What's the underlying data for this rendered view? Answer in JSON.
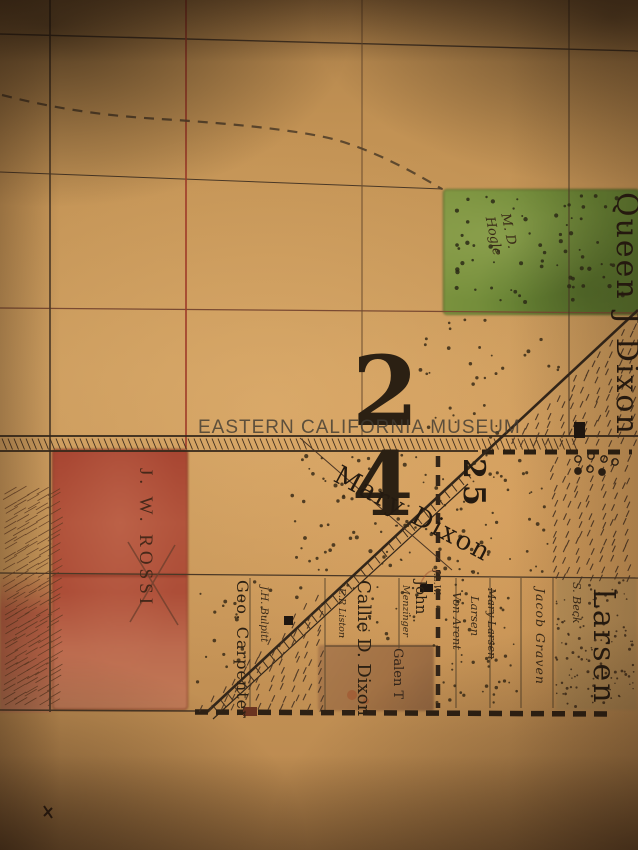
{
  "image_type": "photograph of a hand-drawn historical plat map",
  "watermark": "EASTERN CALIFORNIA MUSEUM",
  "sections": {
    "main": {
      "digits": [
        "2",
        "4"
      ]
    },
    "east": {
      "number": "25"
    }
  },
  "parcels": {
    "rossi": "J. W. ROSSI",
    "hogle_line1": "M. D.",
    "hogle_line2": "Hogle",
    "queen_dixon": "Queen J Dixon",
    "mary_dixon": "Mary Dixon",
    "carpenter": "Geo. Carpenter",
    "bulpitt": "J.H. Bulpitt",
    "callie_dixon": "Callie D. Dixon",
    "liston": "E.R Liston",
    "john": "John",
    "menzinger": "Menzinger",
    "jlw": "J.L.W.",
    "galen": "Galen T",
    "von_arent": "Von Arent",
    "larsen_small": "Larsen",
    "mary_larsen": "Mary Larsen",
    "jacob_graven": "Jacob Graven",
    "s_beck": "S. Beck",
    "larsen_large": "Larsen"
  },
  "colors": {
    "parchment": "#c79a5e",
    "red_grid_line": "#9e3a28",
    "black_ink": "#2b2013",
    "green_parcel": "#6f8b3b",
    "red_parcel": "#b05038",
    "brown_parcel": "#a4744a",
    "watermark_gray": "#4b443c"
  }
}
